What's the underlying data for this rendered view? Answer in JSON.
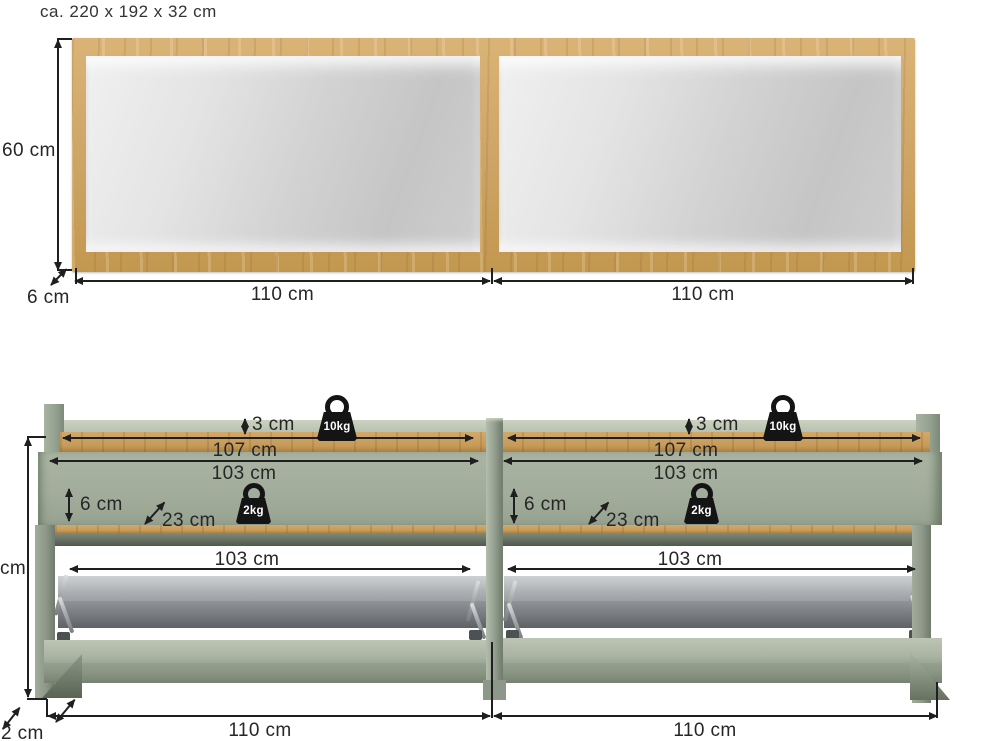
{
  "title": "ca. 220 x 192 x 32 cm",
  "colors": {
    "wood": "#cda466",
    "sage": "#a7b1a0",
    "sage_dark": "#8d9889",
    "metal_gray": "#9a9ea1",
    "dimension_line": "#1f1f1f",
    "glass": "#d6d6d6",
    "background": "#ffffff"
  },
  "mirror": {
    "height": "60 cm",
    "frame_thickness": "6 cm",
    "left_width": "110 cm",
    "right_width": "110 cm"
  },
  "bench": {
    "left": {
      "top_edge": "3 cm",
      "top_width": "107 cm",
      "inner_width": "103 cm",
      "front_height": "6 cm",
      "depth": "23 cm",
      "flap_width": "103 cm",
      "total_width": "110 cm",
      "top_load": "10kg",
      "flap_load": "2kg"
    },
    "right": {
      "top_edge": "3 cm",
      "top_width": "107 cm",
      "inner_width": "103 cm",
      "front_height": "6 cm",
      "depth": "23 cm",
      "flap_width": "103 cm",
      "total_width": "110 cm",
      "top_load": "10kg",
      "flap_load": "2kg"
    },
    "height_partial": "cm",
    "depth_partial": "32 cm"
  }
}
